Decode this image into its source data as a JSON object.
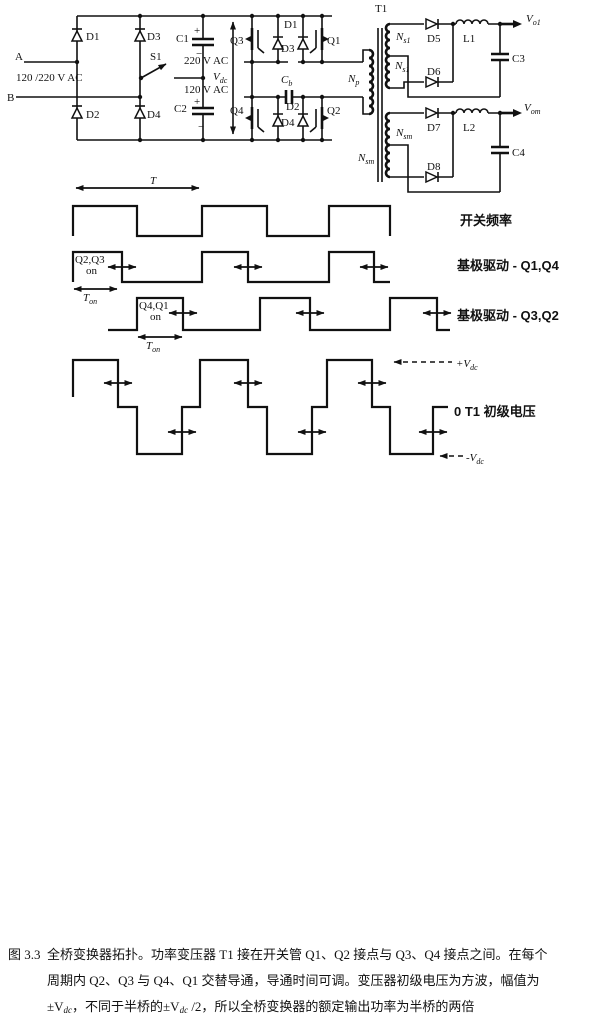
{
  "circuit": {
    "input": {
      "terminal_a": "A",
      "terminal_b": "B",
      "ac_rating": "120 /220 V AC",
      "switch": "S1",
      "d1": "D1",
      "d2": "D2",
      "d3": "D3",
      "d4": "D4",
      "c1": "C1",
      "c1_voltage": "220 V AC",
      "c2": "C2",
      "c2_voltage": "120 V AC",
      "plus": "+",
      "minus": "−",
      "vdc_main": "V",
      "vdc_sub": "dc"
    },
    "bridge": {
      "q1": "Q1",
      "q2": "Q2",
      "q3": "Q3",
      "q4": "Q4",
      "d1": "D1",
      "d2": "D2",
      "d3": "D3",
      "d4": "D4",
      "cb_main": "C",
      "cb_sub": "b"
    },
    "transformer": {
      "name": "T1",
      "np_main": "N",
      "np_sub": "p",
      "ns1_main": "N",
      "ns1_sub": "s1",
      "nsm_main": "N",
      "nsm_sub": "sm"
    },
    "output1": {
      "d5": "D5",
      "d6": "D6",
      "l1": "L1",
      "c3": "C3",
      "v_main": "V",
      "v_sub": "o1"
    },
    "output2": {
      "d7": "D7",
      "d8": "D8",
      "l2": "L2",
      "c4": "C4",
      "v_main": "V",
      "v_sub": "om"
    }
  },
  "waveforms": {
    "period_label": "T",
    "ton_main": "T",
    "ton_sub": "on",
    "w2_on_line1": "Q2,Q3",
    "w2_on_line2": "on",
    "w3_on_line1": "Q4,Q1",
    "w3_on_line2": "on",
    "label_switching_freq": "开关频率",
    "label_base_drive_q1q4": "基极驱动 - Q1,Q4",
    "label_base_drive_q3q2": "基极驱动 - Q3,Q2",
    "plus_vdc_main": "+V",
    "plus_vdc_sub": "dc",
    "label_primary_voltage": "0 T1 初级电压",
    "minus_vdc_main": "-V",
    "minus_vdc_sub": "dc"
  },
  "caption": {
    "figure_number": "图 3.3",
    "line1": "全桥变换器拓扑。功率变压器 T1 接在开关管 Q1、Q2 接点与 Q3、Q4 接点之间。在每个",
    "line2": "周期内 Q2、Q3 与 Q4、Q1 交替导通，导通时间可调。变压器初级电压为方波，幅值为",
    "line3_part1": "±V",
    "line3_sub1": "dc",
    "line3_part2": "，不同于半桥的±V",
    "line3_sub2": "dc",
    "line3_part3": " /2，所以全桥变换器的额定输出功率为半桥的两倍"
  }
}
